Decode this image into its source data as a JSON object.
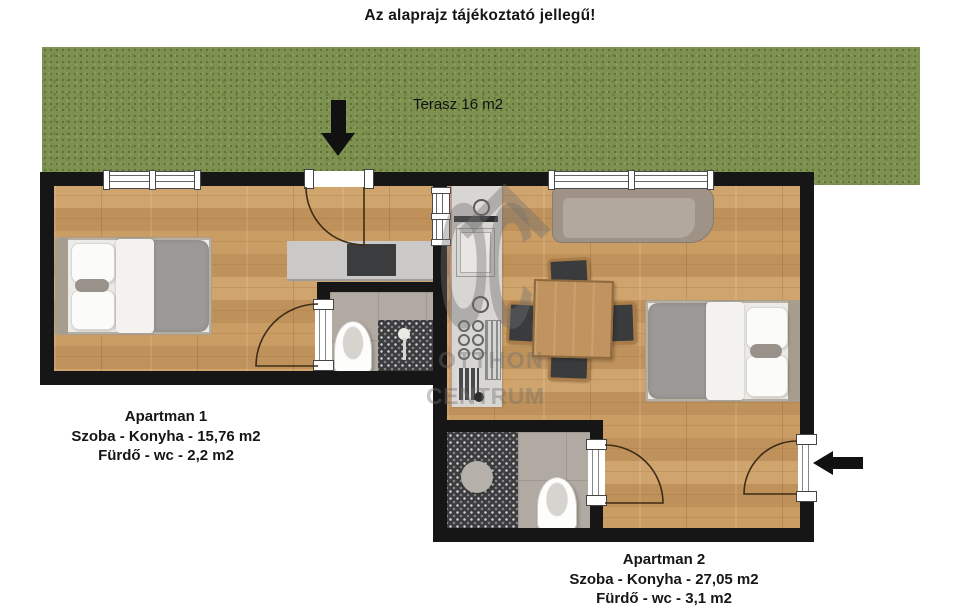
{
  "title": "Az alaprajz tájékoztató jellegű!",
  "terrace": {
    "label": "Terasz 16 m2"
  },
  "apartment1": {
    "name": "Apartman 1",
    "area_line": "Szoba - Konyha - 15,76 m2",
    "bath_line": "Fürdő - wc - 2,2 m2"
  },
  "apartment2": {
    "name": "Apartman 2",
    "area_line": "Szoba - Konyha - 27,05 m2",
    "bath_line": "Fürdő - wc - 3,1 m2"
  },
  "watermark": {
    "logo": "OC",
    "line1": "OTTHON",
    "line2": "CENTRUM"
  },
  "colors": {
    "grass": "#7d9150",
    "wood_floor": "#c79a63",
    "wall": "#161616",
    "counter": "#cbc9c7",
    "cooktop": "#3a3c3e",
    "tile_dark": "#3d3d3f",
    "tile_gray": "#b1aaa2",
    "sofa": "#9e9386",
    "duvet": "#9c9996",
    "table_wood": "#c0935f",
    "watermark": "#707070"
  }
}
